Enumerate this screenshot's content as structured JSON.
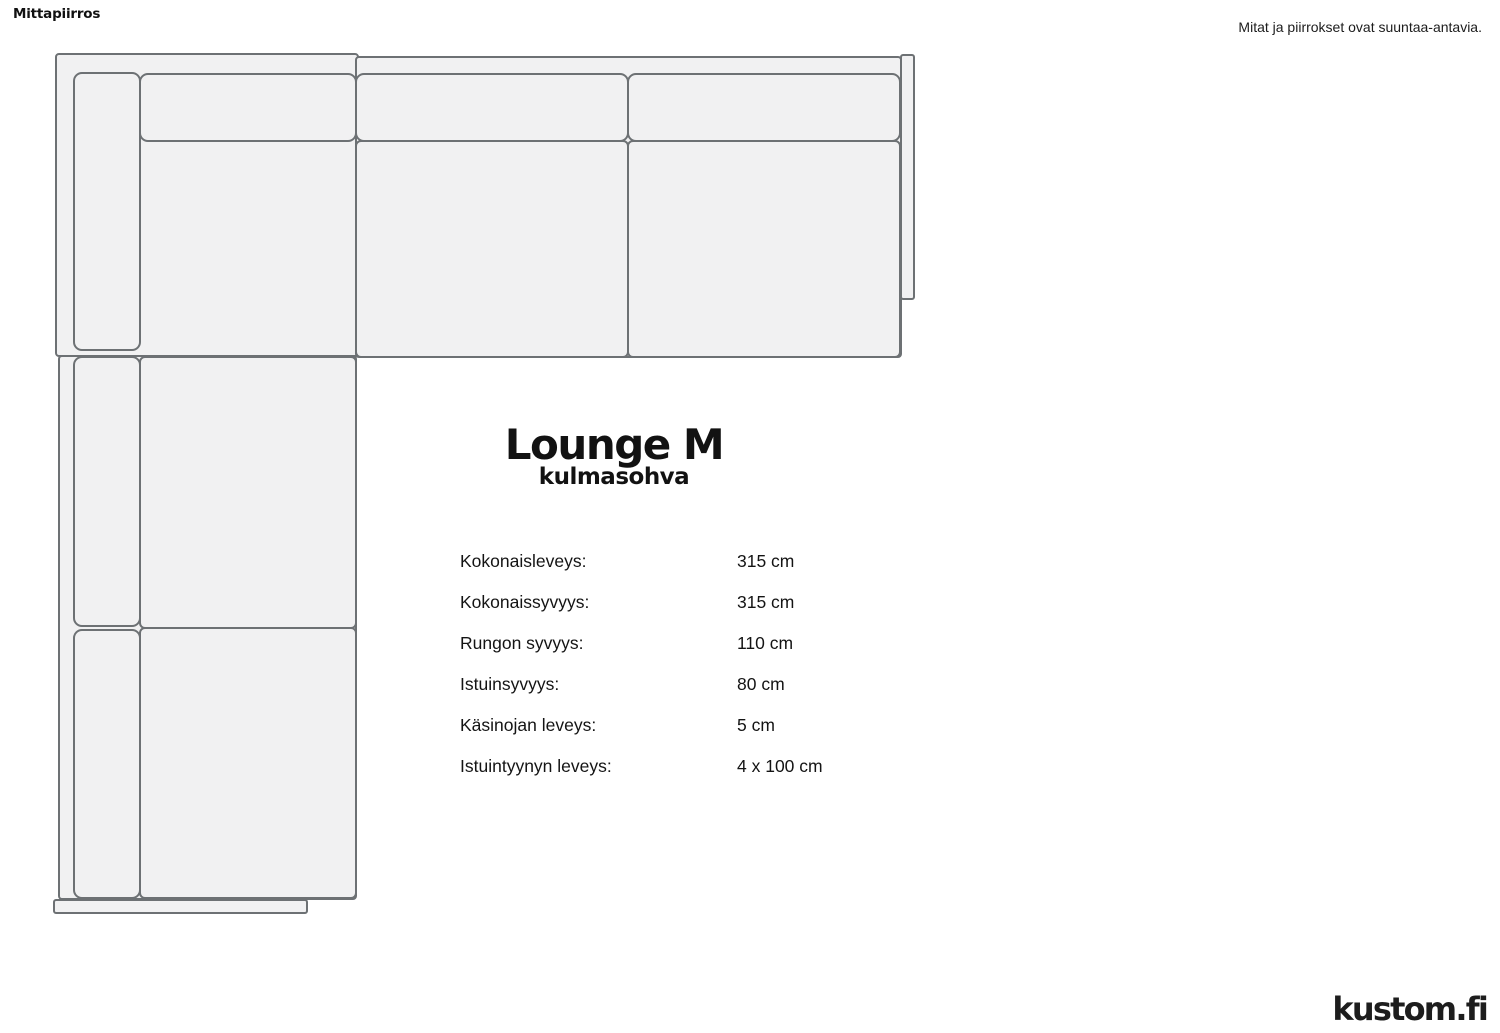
{
  "page": {
    "title": "Mittapiirros",
    "disclaimer": "Mitat ja piirrokset ovat suuntaa-antavia.",
    "logo_text": "kustom.fi",
    "background_color": "#ffffff"
  },
  "product": {
    "name": "Lounge M",
    "type": "kulmasohva"
  },
  "specs": [
    {
      "label": "Kokonaisleveys:",
      "value": "315 cm"
    },
    {
      "label": "Kokonaissyvyys:",
      "value": "315 cm"
    },
    {
      "label": "Rungon syvyys:",
      "value": "110 cm"
    },
    {
      "label": "Istuinsyvyys:",
      "value": "80 cm"
    },
    {
      "label": "Käsinojan leveys:",
      "value": "5 cm"
    },
    {
      "label": "Istuintyynyn leveys:",
      "value": "4 x 100 cm"
    }
  ],
  "drawing": {
    "description": "Top view technical drawing of an L-shaped corner sofa",
    "colors": {
      "fill": "#f1f1f2",
      "stroke": "#6d7174"
    }
  }
}
